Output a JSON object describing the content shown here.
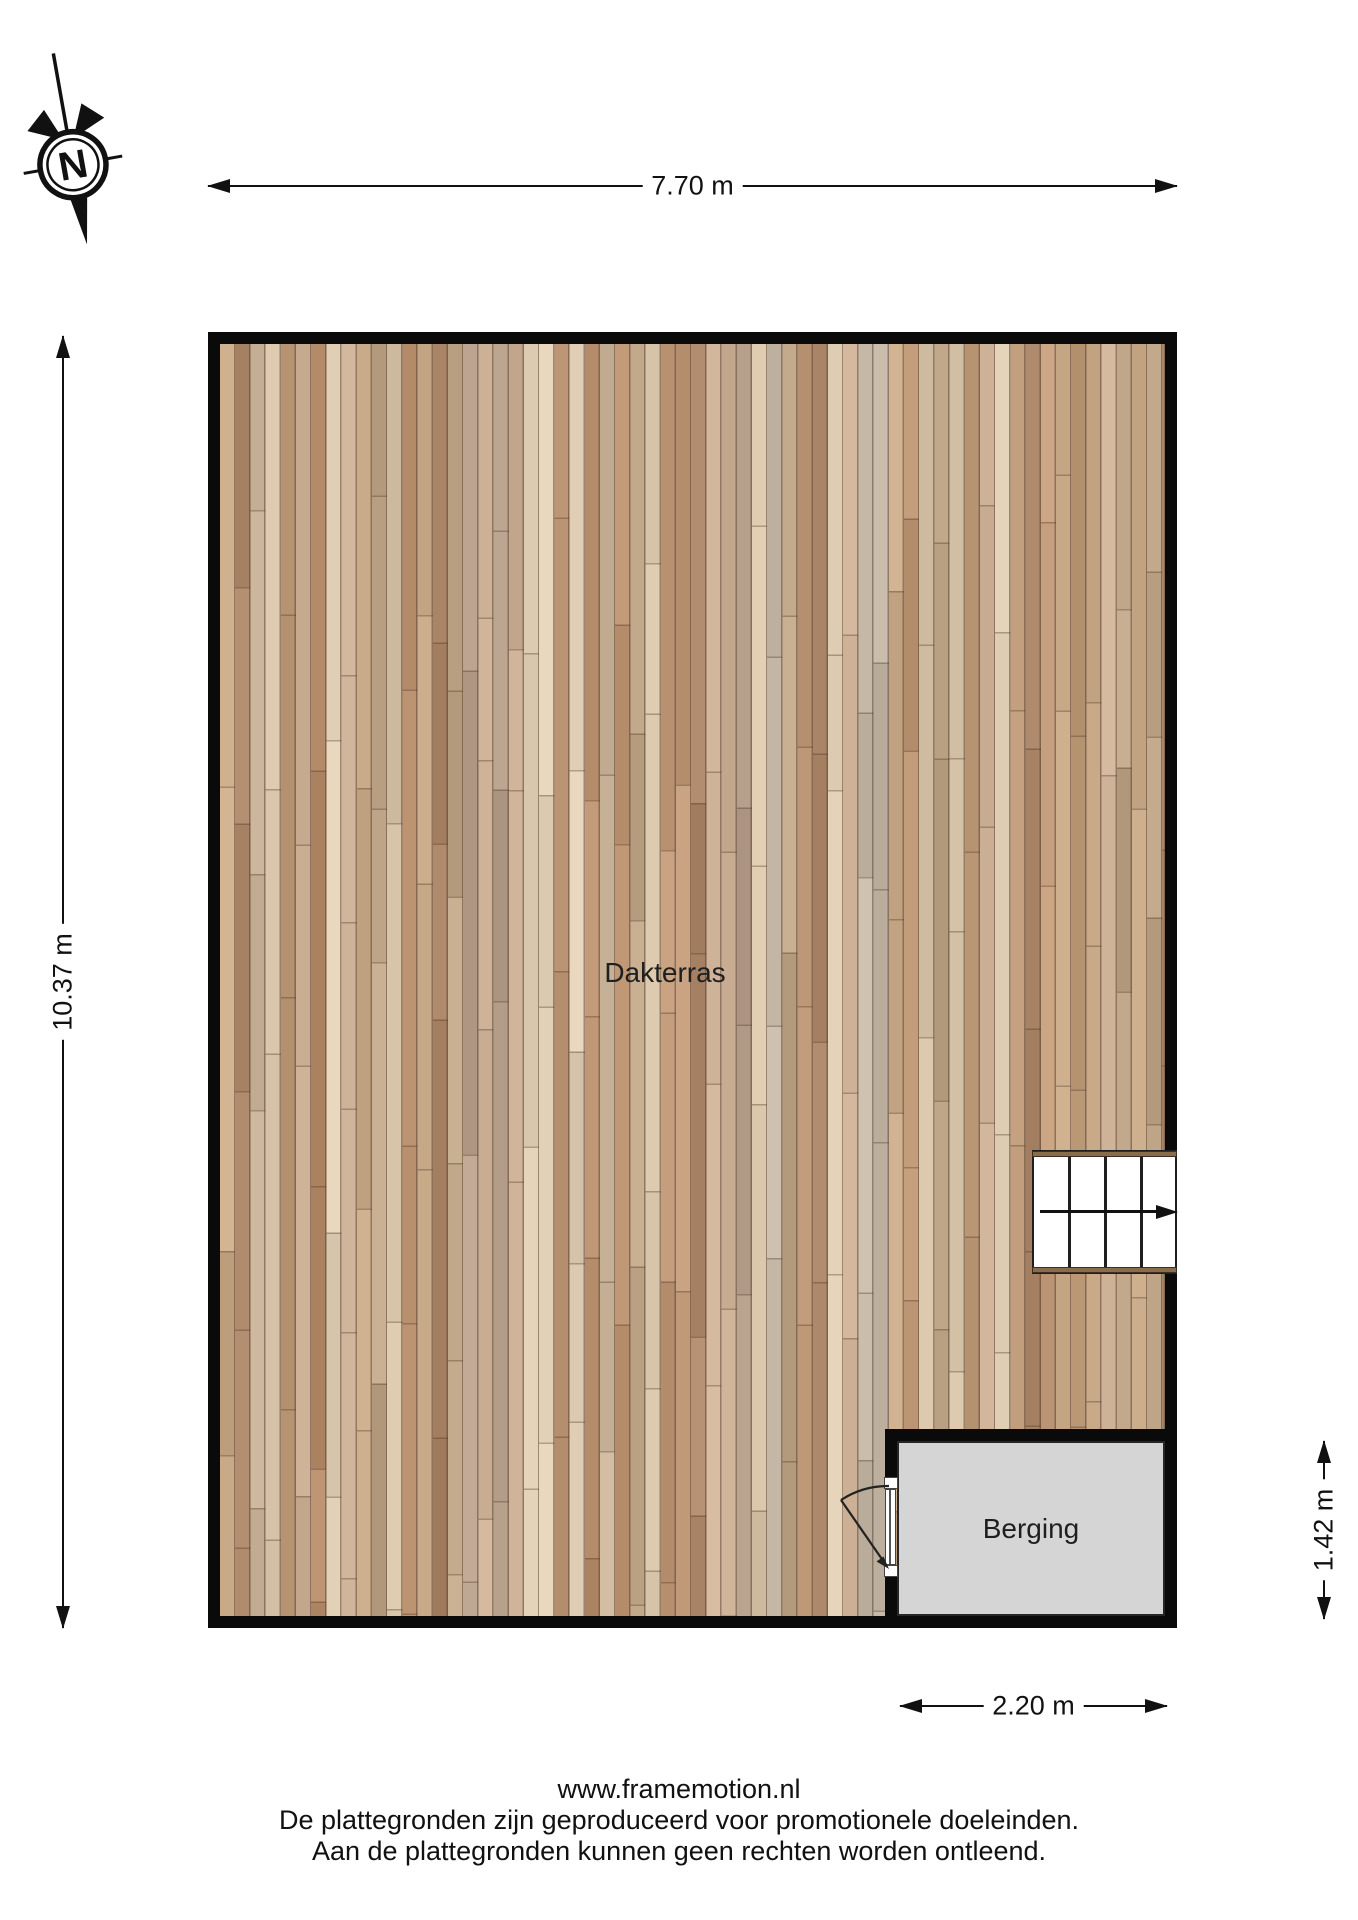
{
  "compass": {
    "north_label": "N"
  },
  "dimensions": {
    "width_total": "7.70 m",
    "height_total": "10.37 m",
    "storage_height": "1.42 m",
    "storage_width": "2.20 m"
  },
  "rooms": {
    "terrace_label": "Dakterras",
    "storage_label": "Berging"
  },
  "footer": {
    "line1": "www.framemotion.nl",
    "line2": "De plattegronden zijn geproduceerd voor promotionele doeleinden.",
    "line3": "Aan de plattegronden kunnen geen rechten worden ontleend."
  },
  "colors": {
    "wall": "#0a0a0a",
    "storage_floor": "#d5d5d5",
    "stair_edge": "#8a6c4d",
    "deck_base": "#c9ab8c",
    "deck_palette": [
      "#cdb197",
      "#c09a78",
      "#d6c3a8",
      "#b78e6c",
      "#c7a988",
      "#b8a18c",
      "#ddcbb2",
      "#aa8567",
      "#cbb69b",
      "#bfa587",
      "#c4b6a4",
      "#b99775"
    ]
  }
}
